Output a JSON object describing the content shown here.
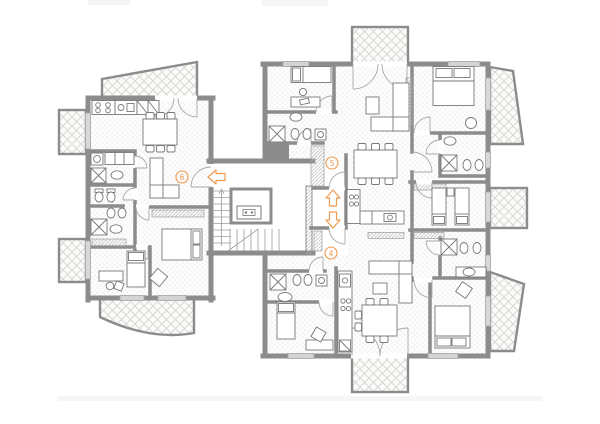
{
  "document": {
    "type": "architectural-floor-plan",
    "description": "Apartment building storey plan with three units, central stair and elevator core, hatched balconies and furniture symbols"
  },
  "units": [
    {
      "label": "6",
      "position": "left-apartment"
    },
    {
      "label": "5",
      "position": "upper-middle-apartment"
    },
    {
      "label": "4",
      "position": "lower-middle-apartment"
    }
  ],
  "annotations": {
    "entry_arrows": [
      {
        "direction": "left",
        "near_unit": "6"
      },
      {
        "direction": "up",
        "near_unit": "5"
      },
      {
        "direction": "down",
        "near_unit": "4"
      }
    ]
  },
  "colors": {
    "background": "#ffffff",
    "walls": "#8c8c8c",
    "thin_lines": "#9c9c9c",
    "furniture_lines": "#787878",
    "balcony_hatch": "#d4d1ce",
    "floor_hatch": "#f0eeeb",
    "wardrobe_hatch": "#b8b8b8",
    "accent_orange": "#ee9b50"
  },
  "icons": [
    "stairs-icon",
    "elevator-icon",
    "double-bed-icon",
    "single-bed-icon",
    "dining-table-icon",
    "sofa-icon",
    "armchair-icon",
    "desk-icon",
    "toilet-icon",
    "bidet-icon",
    "sink-icon",
    "shower-icon",
    "washing-machine-icon",
    "stove-icon",
    "kitchen-sink-icon",
    "wardrobe-icon",
    "balcony",
    "window",
    "door-swing"
  ]
}
